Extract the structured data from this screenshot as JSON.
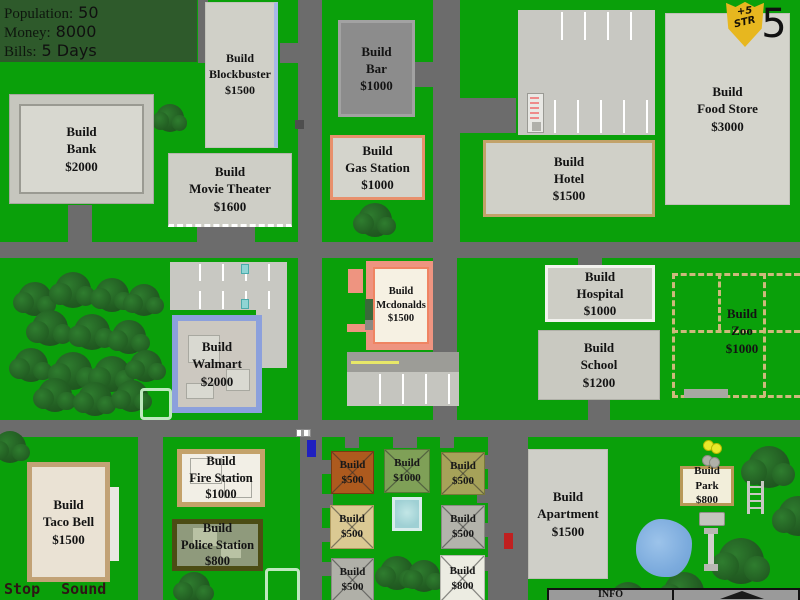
{
  "hud": {
    "population_label": "Population:",
    "population_value": "50",
    "money_label": "Money:",
    "money_value": "8000",
    "bills_label": "Bills:",
    "bills_value": "5 Days"
  },
  "badge": {
    "bonus": "+5",
    "stat": "STR",
    "count": "5"
  },
  "audio_controls": {
    "stop": "Stop",
    "sound": "Sound"
  },
  "info_bar": {
    "label": "INFO"
  },
  "buildings": {
    "blockbuster": {
      "action": "Build",
      "name": "Blockbuster",
      "price": "$1500"
    },
    "bar": {
      "action": "Build",
      "name": "Bar",
      "price": "$1000"
    },
    "movie_theater": {
      "action": "Build",
      "name": "Movie Theater",
      "price": "$1600"
    },
    "gas_station": {
      "action": "Build",
      "name": "Gas Station",
      "price": "$1000"
    },
    "bank": {
      "action": "Build",
      "name": "Bank",
      "price": "$2000"
    },
    "hotel": {
      "action": "Build",
      "name": "Hotel",
      "price": "$1500"
    },
    "food_store": {
      "action": "Build",
      "name": "Food Store",
      "price": "$3000"
    },
    "mcdonalds": {
      "action": "Build",
      "name": "Mcdonalds",
      "price": "$1500"
    },
    "hospital": {
      "action": "Build",
      "name": "Hospital",
      "price": "$1000"
    },
    "school": {
      "action": "Build",
      "name": "School",
      "price": "$1200"
    },
    "zoo": {
      "action": "Build",
      "name": "Zoo",
      "price": "$1000"
    },
    "walmart": {
      "action": "Build",
      "name": "Walmart",
      "price": "$2000"
    },
    "taco_bell": {
      "action": "Build",
      "name": "Taco Bell",
      "price": "$1500"
    },
    "fire_station": {
      "action": "Build",
      "name": "Fire Station",
      "price": "$1000"
    },
    "police_station": {
      "action": "Build",
      "name": "Police Station",
      "price": "$800"
    },
    "apartment": {
      "action": "Build",
      "name": "Apartment",
      "price": "$1500"
    },
    "park": {
      "action": "Build",
      "name": "Park",
      "price": "$800"
    }
  },
  "house_lots": {
    "orange": {
      "action": "Build",
      "price": "$500"
    },
    "green": {
      "action": "Build",
      "price": "$1000"
    },
    "khaki": {
      "action": "Build",
      "price": "$500"
    },
    "wheat": {
      "action": "Build",
      "price": "$500"
    },
    "gray_mid": {
      "action": "Build",
      "price": "$500"
    },
    "gray_low": {
      "action": "Build",
      "price": "$500"
    },
    "white": {
      "action": "Build",
      "price": "$800"
    }
  },
  "colors": {
    "grass": "#0aa00a",
    "road": "#6c6c6c",
    "panel_green": "#2e5a2b",
    "badge_gold": "#e7b71f"
  }
}
